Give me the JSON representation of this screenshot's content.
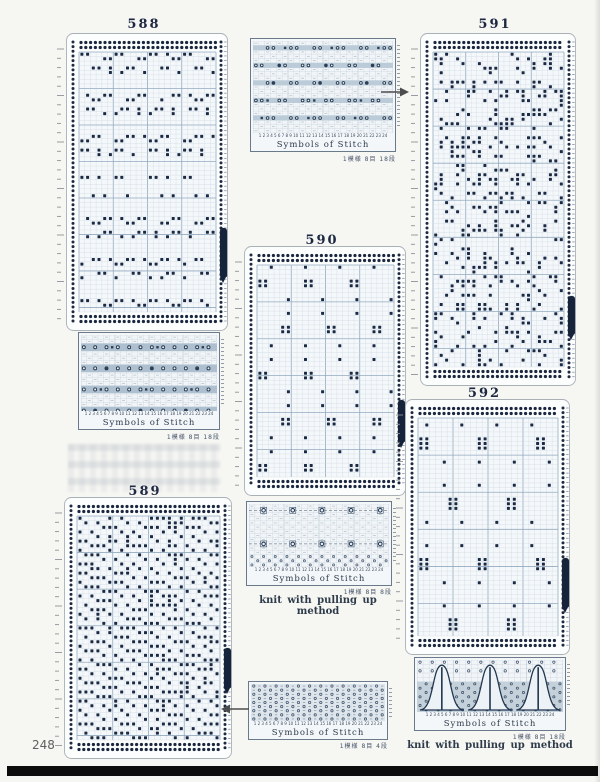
{
  "page": {
    "number": "248"
  },
  "labels": {
    "symbols_of_stitch": "Symbols of Stitch",
    "knit_method": "knit with pulling up method"
  },
  "icons": {
    "arrow_right": "→",
    "arrow_left": "←"
  },
  "cards": {
    "c588": {
      "title": "588",
      "style": "bands",
      "cols": 24,
      "seed": 588,
      "marker": {
        "top": 0.655,
        "h": 55
      }
    },
    "c589": {
      "title": "589",
      "style": "dense",
      "cols": 24,
      "seed": 589,
      "marker": {
        "top": 0.576,
        "h": 46
      }
    },
    "c590": {
      "title": "590",
      "style": "clusters",
      "cols": 24,
      "seed": 590,
      "marker": {
        "top": 0.616,
        "h": 48
      }
    },
    "c591": {
      "title": "591",
      "style": "scatter",
      "cols": 24,
      "seed": 591,
      "marker": {
        "top": 0.745,
        "h": 44
      }
    },
    "c592": {
      "title": "592",
      "style": "sparse-pairs",
      "cols": 24,
      "seed": 592,
      "marker": {
        "top": 0.62,
        "h": 55
      }
    }
  },
  "charts": {
    "symTop": {
      "style": "loop-bands",
      "band_every": 4,
      "thick": false,
      "cols": 24,
      "numbers": "1 2 3 4 5 6 7 8 9 10 11 12 13 14 15 16 17 18 19 20 21 22 23 24",
      "caption": "1模様 8目 18段"
    },
    "sym588": {
      "style": "loop-bands",
      "band_every": 5,
      "thick": true,
      "cols": 24,
      "numbers": "1 2 3 4 5 6 7 8 9 10 11 12 13 14 15 16 17 18 19 20 21 22 23 24",
      "caption": "1模様 8目 18段"
    },
    "sym590": {
      "style": "sparse-loops",
      "cols": 24,
      "numbers": "1 2 3 4 5 6 7 8 9 10 11 12 13 14 15 16 17 18 19 20 21 22 23 24",
      "caption": "1模様 8目 8段"
    },
    "symBot": {
      "style": "allover",
      "cols": 24,
      "numbers": "1 2 3 4 5 6 7 8 9 10 11 12 13 14 15 16 17 18 19 20 21 22 23 24",
      "caption": "1模様 8目 4段"
    },
    "symBR": {
      "style": "arches",
      "cols": 24,
      "numbers": "1 2 3 4 5 6 7 8 9 10 11 12 13 14 15 16 17 18 19 20 21 22 23 24",
      "caption": "1模様 8目 18段"
    }
  }
}
